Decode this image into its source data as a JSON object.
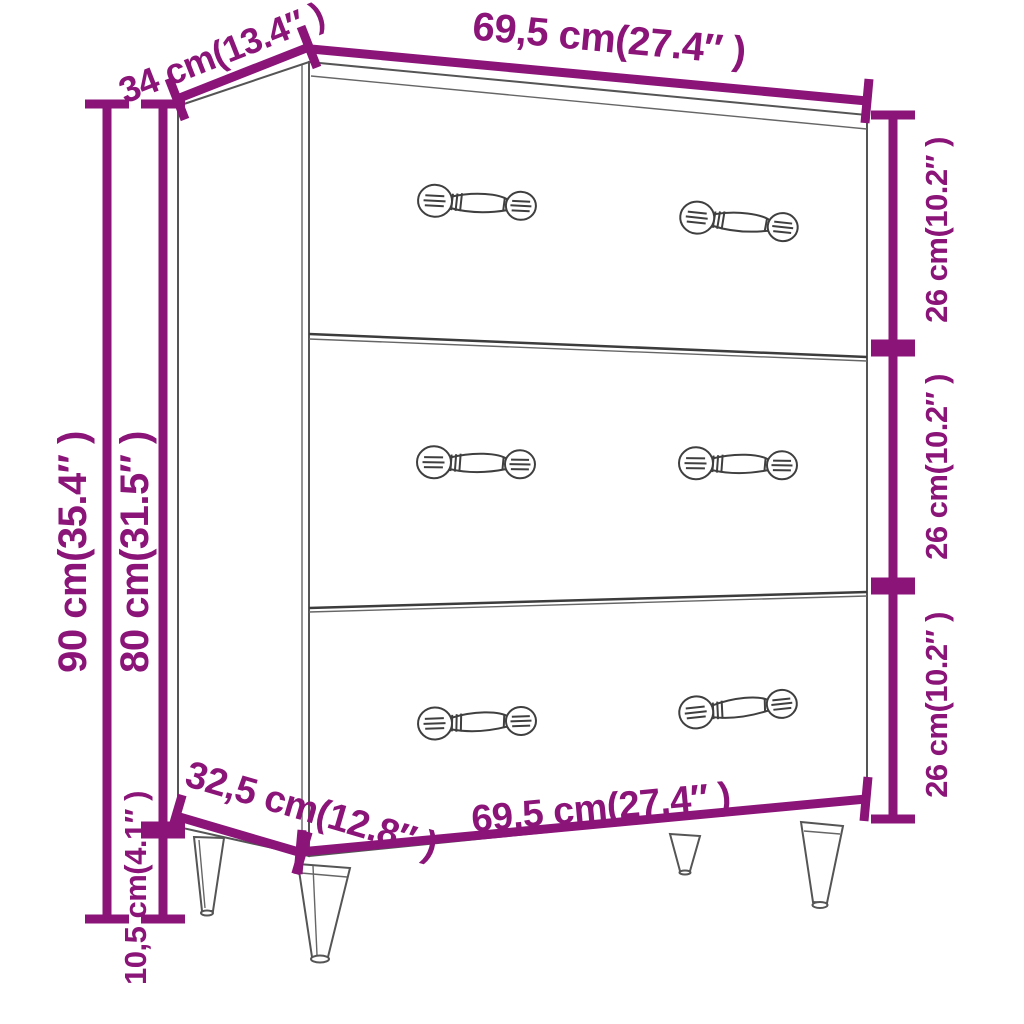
{
  "diagram": {
    "kind": "furniture-dimension-diagram",
    "subject": "sideboard-with-3-drawers",
    "colors": {
      "dimension_accent": "#8a1478",
      "outline_gray": "#555555",
      "background": "#ffffff"
    },
    "dimensions": {
      "top_depth": "34 cm(13.4″ )",
      "top_width": "69,5 cm(27.4″ )",
      "drawer1_height": "26 cm(10.2″ )",
      "drawer2_height": "26 cm(10.2″ )",
      "drawer3_height": "26 cm(10.2″ )",
      "total_height": "90 cm(35.4″ )",
      "body_height": "80 cm(31.5″ )",
      "leg_height": "10,5 cm(4.1″ )",
      "bottom_depth": "32,5 cm(12.8″ )",
      "bottom_width": "69,5 cm(27.4″ )"
    }
  }
}
